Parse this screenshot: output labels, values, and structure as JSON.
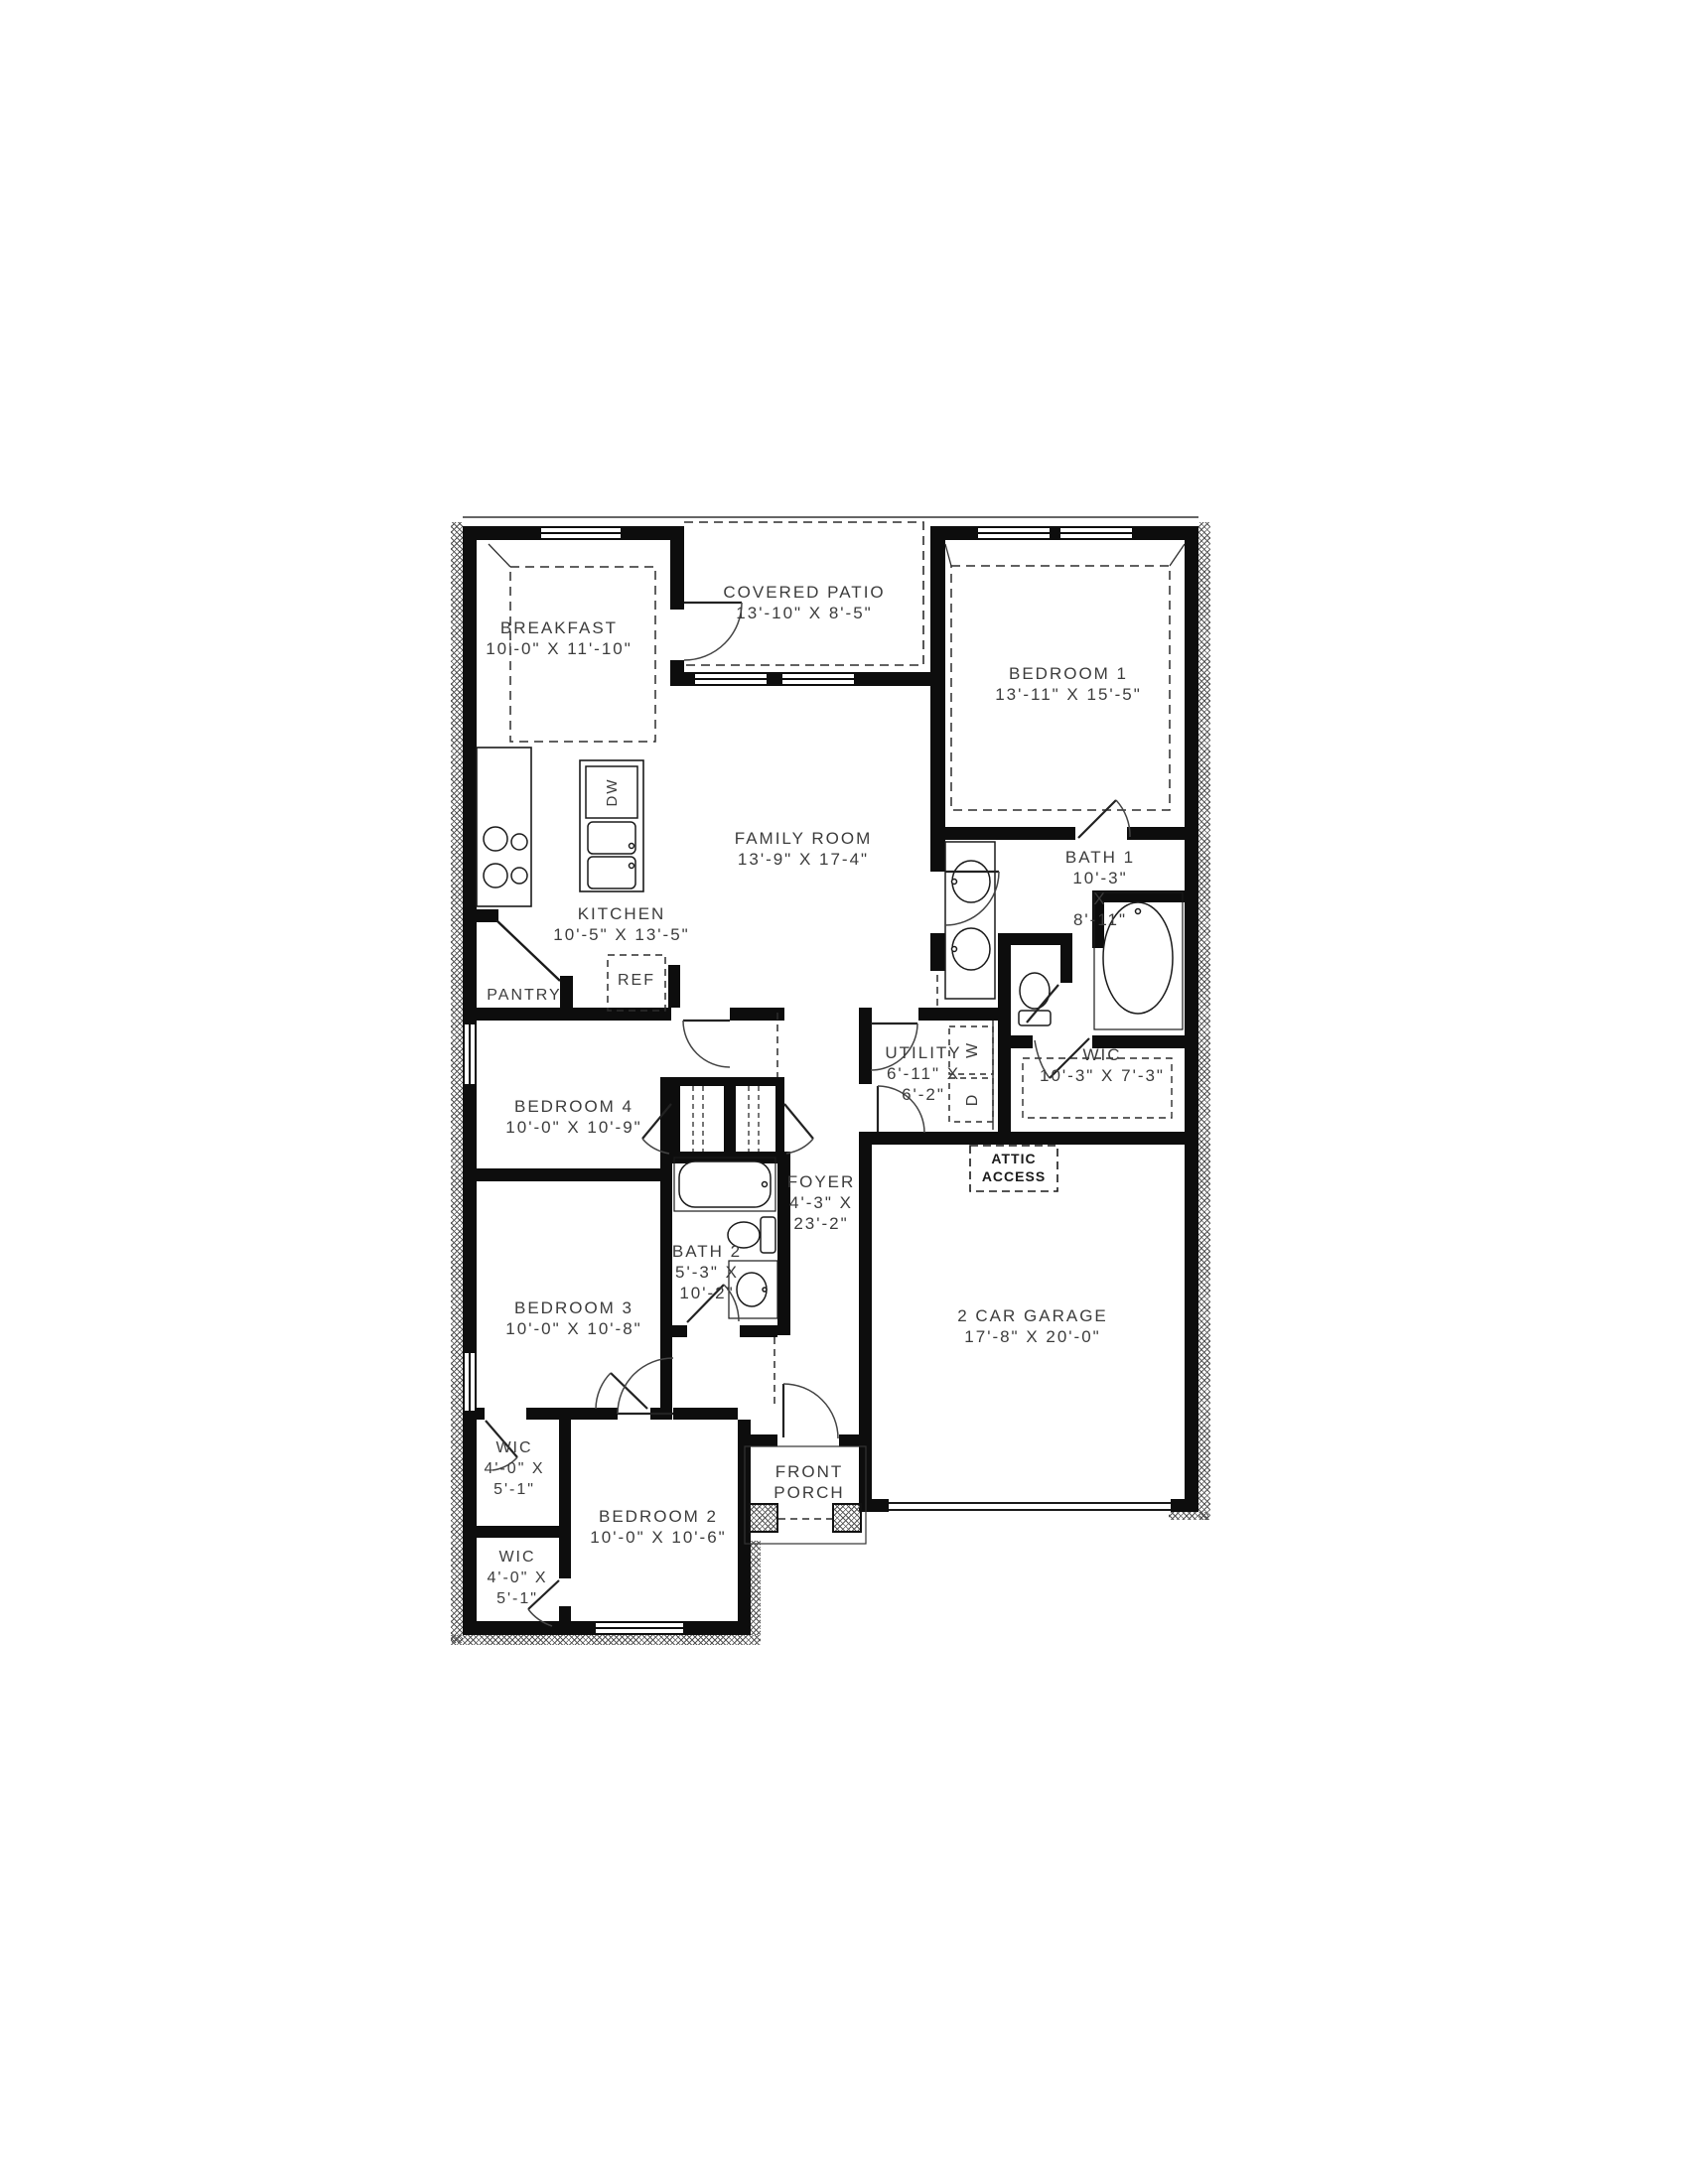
{
  "drawing": {
    "type": "residential floor plan",
    "colors": {
      "wall": "#0d0d0d",
      "text": "#3c3c3c",
      "background": "#ffffff"
    }
  },
  "rooms": {
    "breakfast": {
      "lines": [
        "BREAKFAST",
        "10'-0\" X 11'-10\""
      ]
    },
    "covered_patio": {
      "lines": [
        "COVERED PATIO",
        "13'-10\" X 8'-5\""
      ]
    },
    "bedroom1": {
      "lines": [
        "BEDROOM 1",
        "13'-11\" X 15'-5\""
      ]
    },
    "family_room": {
      "lines": [
        "FAMILY ROOM",
        "13'-9\" X 17-4\""
      ]
    },
    "kitchen": {
      "lines": [
        "KITCHEN",
        "10'-5\" X 13'-5\""
      ]
    },
    "pantry": {
      "lines": [
        "PANTRY"
      ]
    },
    "bath1": {
      "lines": [
        "BATH 1",
        "10'-3\"",
        "X",
        "8'-11\""
      ]
    },
    "wic_master": {
      "lines": [
        "WIC",
        "10'-3\" X 7'-3\""
      ]
    },
    "utility": {
      "lines": [
        "UTILITY",
        "6'-11\" X",
        "6'-2\""
      ]
    },
    "foyer": {
      "lines": [
        "FOYER",
        "4'-3\" X",
        "23'-2\""
      ]
    },
    "attic_access": {
      "lines": [
        "ATTIC",
        "ACCESS"
      ]
    },
    "garage": {
      "lines": [
        "2 CAR GARAGE",
        "17'-8\" X 20'-0\""
      ]
    },
    "bedroom4": {
      "lines": [
        "BEDROOM 4",
        "10'-0\" X 10'-9\""
      ]
    },
    "bath2": {
      "lines": [
        "BATH 2",
        "5'-3\" X",
        "10'-2\""
      ]
    },
    "bedroom3": {
      "lines": [
        "BEDROOM 3",
        "10'-0\" X 10'-8\""
      ]
    },
    "wic_bedroom3": {
      "lines": [
        "WIC",
        "4'-0\" X",
        "5'-1\""
      ]
    },
    "wic_bedroom2": {
      "lines": [
        "WIC",
        "4'-0\" X",
        "5'-1\""
      ]
    },
    "bedroom2": {
      "lines": [
        "BEDROOM 2",
        "10'-0\" X 10'-6\""
      ]
    },
    "front_porch": {
      "lines": [
        "FRONT",
        "PORCH"
      ]
    }
  },
  "appliances": {
    "dishwasher": "DW",
    "refrigerator": "REF",
    "washer": "W",
    "dryer": "D"
  }
}
